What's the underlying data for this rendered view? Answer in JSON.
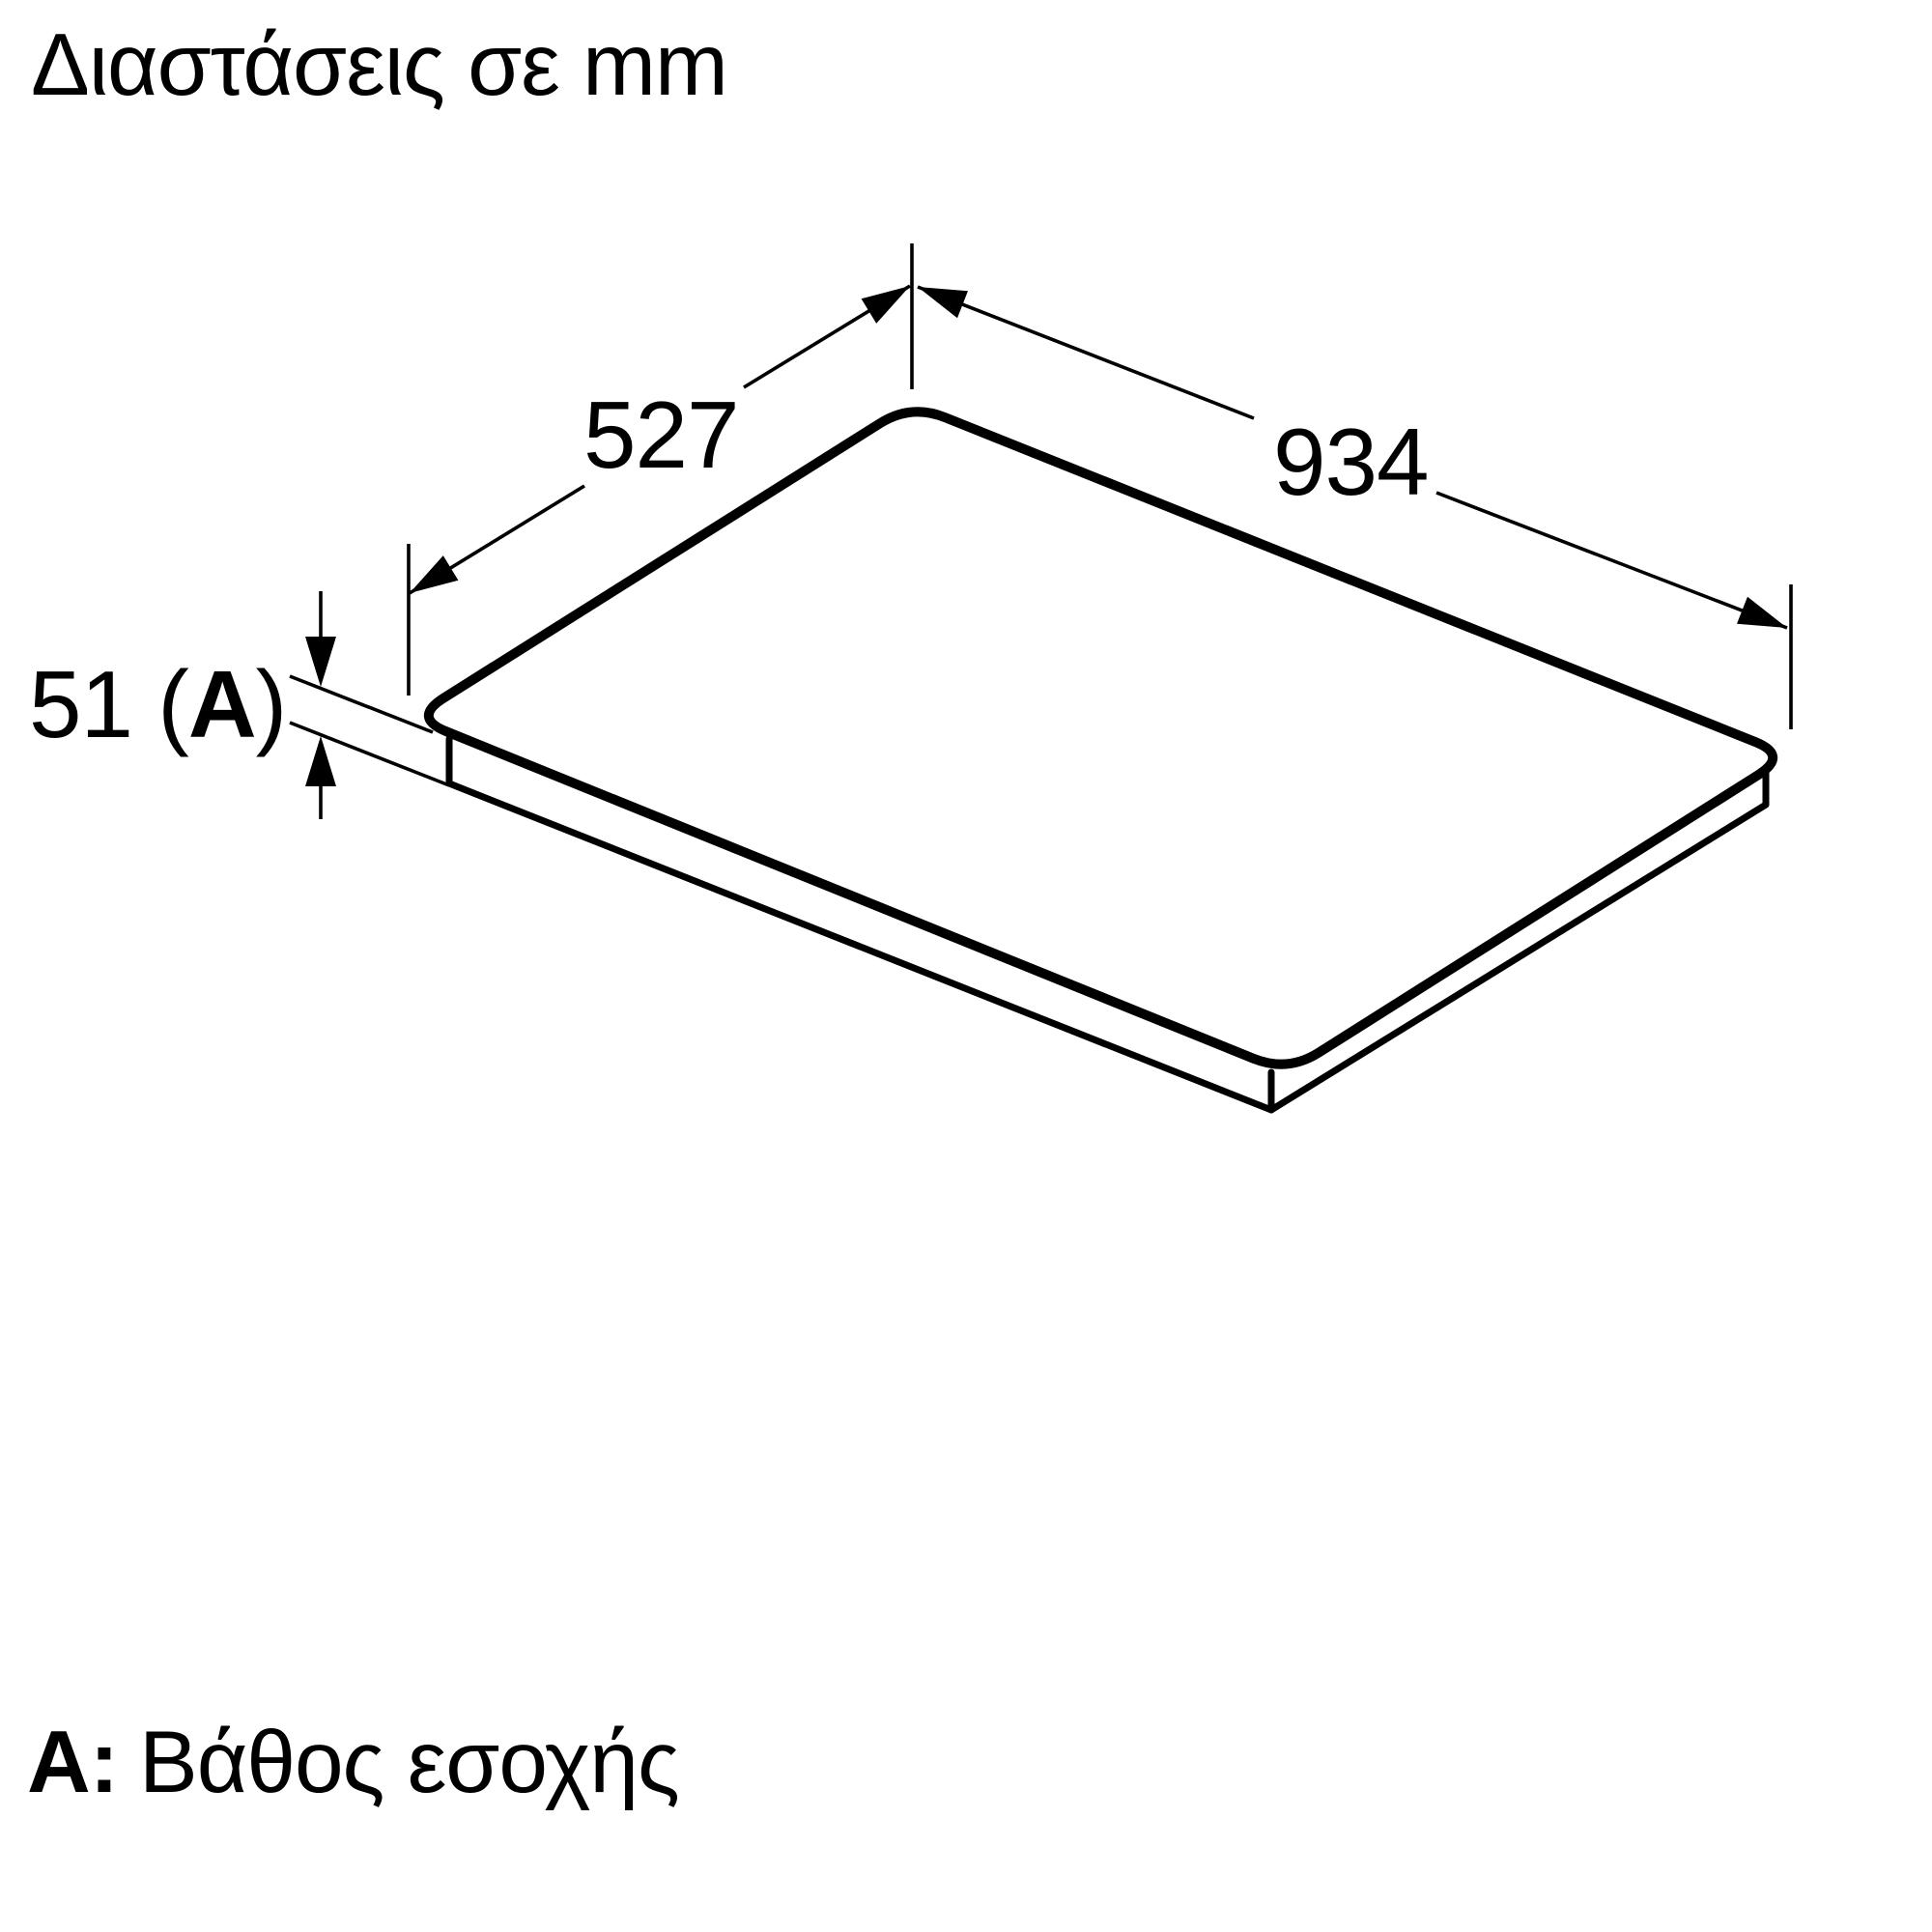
{
  "page": {
    "background": "#ffffff",
    "line_color": "#000000"
  },
  "title": "Διαστάσεις σε mm",
  "dimensions": {
    "depth": {
      "value": "527"
    },
    "width": {
      "value": "934"
    },
    "recess": {
      "prefix": "51 (",
      "letter": "A",
      "suffix": ")"
    }
  },
  "legend": {
    "label": "A:",
    "text": "Βάθος εσοχής"
  }
}
